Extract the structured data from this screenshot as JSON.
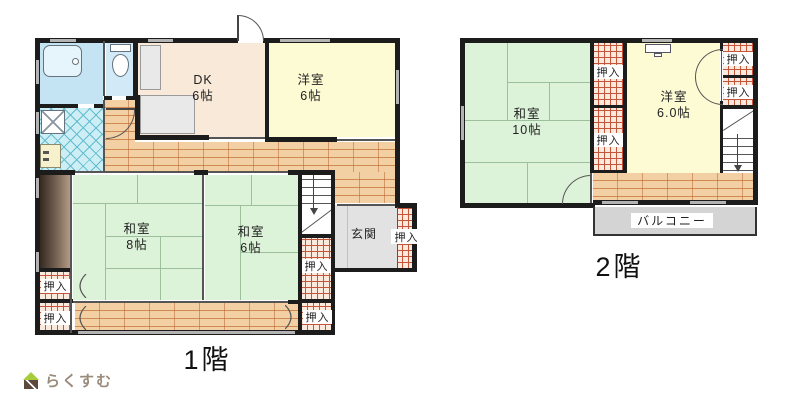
{
  "colors": {
    "wall": "#1c1c1c",
    "tatami": "#ddf3d9",
    "tatami-line": "#9cbf9c",
    "western": "#fdfbd4",
    "dk": "#f8e9d8",
    "wood": "#f3d0a4",
    "wood-line": "#cf8a52",
    "tile": "#cdeef5",
    "tile-line": "#63bccf",
    "bath": "#c4e4f3",
    "toilet": "#d2eaf7",
    "genkan": "#e2e2e2",
    "balcony": "#d4d4d4",
    "closet-bg": "#faeade",
    "closet-line": "#c4553a",
    "window": "#b3b3b3",
    "tokonoma-dark": "#33291f",
    "tokonoma-light": "#b29a85",
    "logo-text": "#9a8b7c",
    "logo-green": "#a9cc3d",
    "logo-brown": "#5d4a3d"
  },
  "floor1": {
    "label": "1階",
    "dk": {
      "name": "DK",
      "size": "6帖"
    },
    "western": {
      "name": "洋室",
      "size": "6帖"
    },
    "washitsu8": {
      "name": "和室",
      "size": "8帖"
    },
    "washitsu6": {
      "name": "和室",
      "size": "6帖"
    },
    "genkan": "玄関"
  },
  "floor2": {
    "label": "2階",
    "washitsu10": {
      "name": "和室",
      "size": "10帖"
    },
    "western": {
      "name": "洋室",
      "size": "6.0帖"
    },
    "balcony": "バルコニー"
  },
  "closet_label": "押入",
  "logo": "らくすむ"
}
